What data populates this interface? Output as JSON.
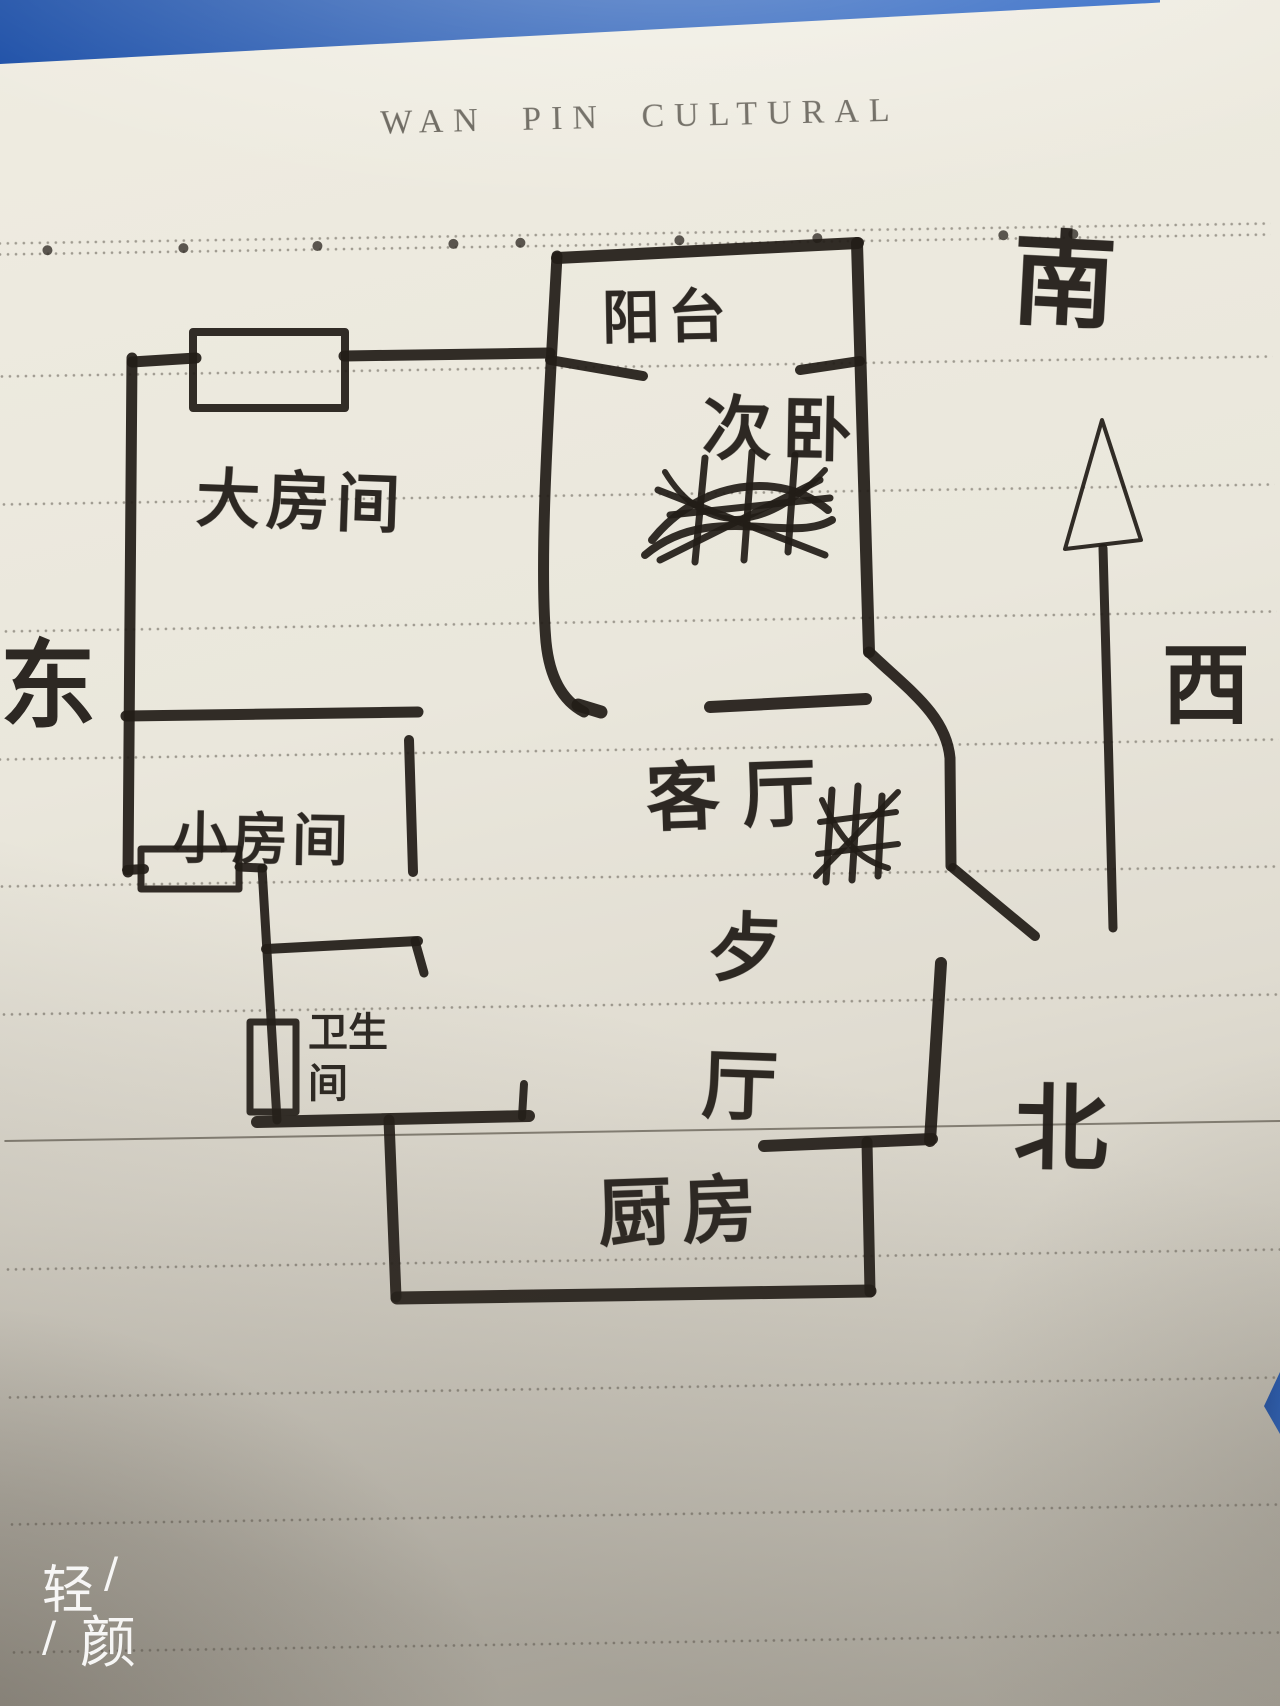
{
  "notebook": {
    "brand_header": "WAN PIN CULTURAL"
  },
  "floor_plan": {
    "rooms": {
      "balcony": "阳台",
      "second_bedroom": "次卧",
      "big_room": "大房间",
      "small_room": "小房间",
      "living_room": "客厅",
      "bathroom": "卫生间",
      "dining_room": "歺厅",
      "kitchen": "厨房"
    },
    "compass": {
      "south": "南",
      "east": "东",
      "west": "西",
      "north": "北"
    }
  },
  "watermark": {
    "char1": "轻",
    "char2": "颜",
    "slash": "/"
  },
  "colors": {
    "desk_blue": "#1f57b4",
    "paper": "#e9e6db",
    "ink": "#221d18",
    "rule_gray": "#5d574c"
  }
}
